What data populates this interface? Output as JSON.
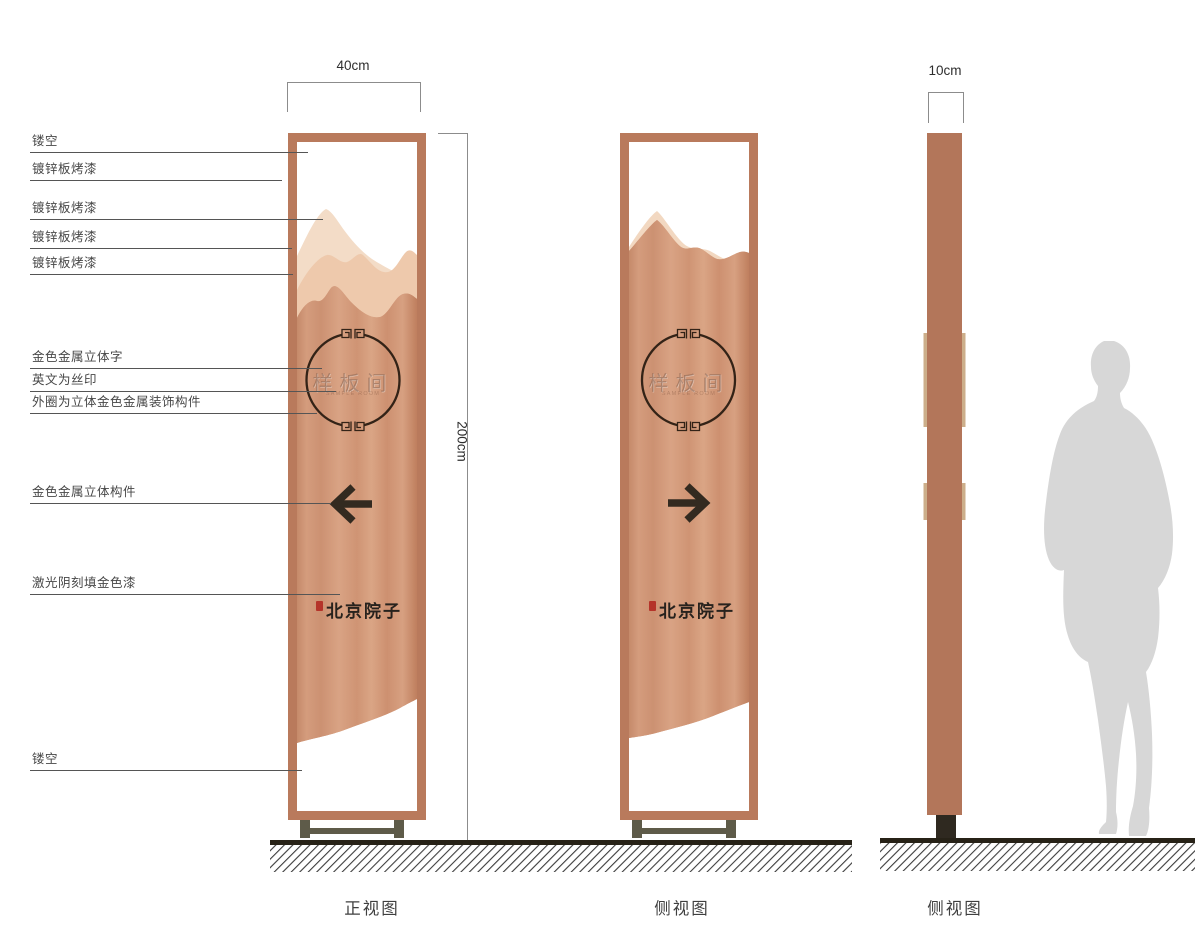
{
  "annotations": {
    "items": [
      {
        "text": "镂空"
      },
      {
        "text": "镀锌板烤漆"
      },
      {
        "text": "镀锌板烤漆"
      },
      {
        "text": "镀锌板烤漆"
      },
      {
        "text": "镀锌板烤漆"
      },
      {
        "text": "金色金属立体字"
      },
      {
        "text": "英文为丝印"
      },
      {
        "text": "外圈为立体金色金属装饰构件"
      },
      {
        "text": "金色金属立体构件"
      },
      {
        "text": "激光阴刻填金色漆"
      },
      {
        "text": "镂空"
      }
    ]
  },
  "dimensions": {
    "front_width": "40cm",
    "total_height": "200cm",
    "side_width": "10cm"
  },
  "panel": {
    "title": "样板间",
    "subtitle_en": "SAMPLE ROOM",
    "brand": "北京院子"
  },
  "views": {
    "front": {
      "caption": "正视图",
      "arrow_direction": "left"
    },
    "side": {
      "caption": "侧视图",
      "arrow_direction": "right"
    },
    "profile": {
      "caption": "侧视图"
    }
  },
  "colors": {
    "frame_copper": "#b97a5c",
    "panel_copper_light": "#d9a384",
    "panel_copper_dark": "#c2825f",
    "mountain_back": "#f3dcc7",
    "mountain_mid": "#eec9ac",
    "ornament_dark": "#332317",
    "arrow_dark": "#332a20",
    "base_olive": "#5e5b49",
    "foot_dark": "#2f2920",
    "ground_dark": "#272217",
    "silhouette_gray": "#d7d7d7",
    "seal_red": "#b5342a"
  }
}
